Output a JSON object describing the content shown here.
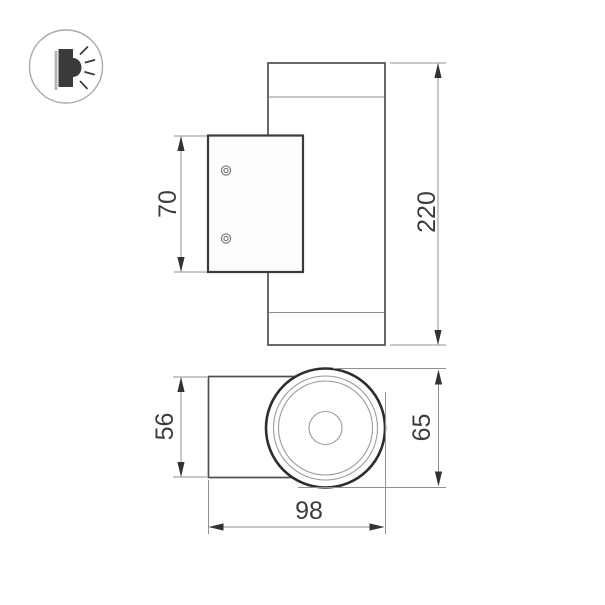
{
  "drawing": {
    "type": "technical-dimension-drawing",
    "subject": "wall-mounted cylindrical luminaire, two orthographic views"
  },
  "icon": {
    "name": "wall-light-icon",
    "description": "circled pictogram of a wall luminaire emitting light sideways"
  },
  "dimensions": {
    "overall_height": "220",
    "bracket_height": "70",
    "body_depth": "56",
    "body_diameter": "65",
    "overall_width": "98"
  },
  "colors": {
    "outline": "#4f4f4f",
    "outline_bold": "#2d2d2d",
    "plate_outline": "#3a3a3a",
    "thin_line": "#8c8c8c",
    "dim_line": "#909090",
    "arrow": "#333333",
    "label": "#3d3d3d",
    "icon_dark": "#3a3a3a",
    "icon_ring": "#a8a8a8",
    "background": "#ffffff"
  }
}
